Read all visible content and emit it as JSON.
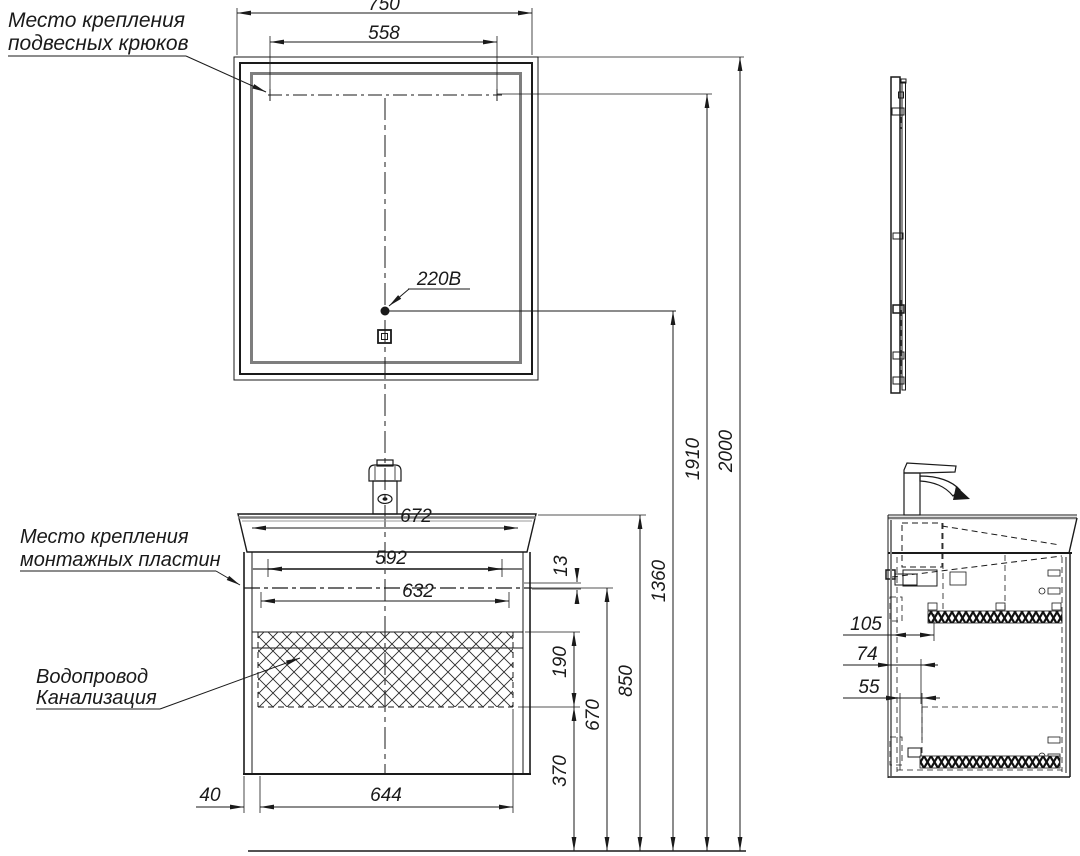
{
  "labels": {
    "hooks_line1": "Место крепления",
    "hooks_line2": "подвесных крюков",
    "plates_line1": "Место крепления",
    "plates_line2": "монтажных пластин",
    "plumbing_line1": "Водопровод",
    "plumbing_line2": "Канализация",
    "outlet": "220В"
  },
  "dimensions": {
    "mirror_width": "750",
    "hooks_span": "558",
    "total_height": "2000",
    "hooks_height": "1910",
    "outlet_height": "1360",
    "sink_height": "850",
    "mount_line_height": "670",
    "clearance_height": "370",
    "hatch_zone_height": "190",
    "plate_gap": "13",
    "sink_width": "672",
    "plates_span": "592",
    "mount_width": "632",
    "cabinet_bottom_width": "644",
    "side_offset": "40",
    "depth_1": "105",
    "depth_2": "74",
    "depth_3": "55"
  },
  "colors": {
    "line": "#1a1a1a",
    "frame_gray": "#7e7e7e",
    "background": "#ffffff"
  }
}
